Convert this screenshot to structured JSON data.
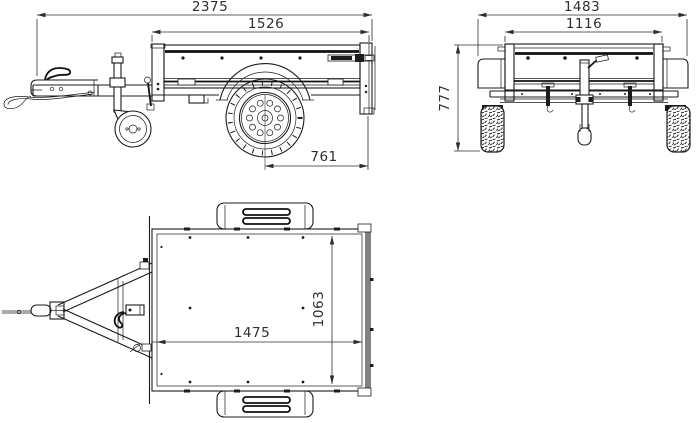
{
  "drawing": {
    "subject": "box trailer three-view technical drawing",
    "background": "#ffffff",
    "line_color": "#1c1c1c",
    "dimension_color": "#2e2e2e"
  },
  "views": {
    "side": {
      "name": "side-view",
      "dims": {
        "overall_length": "2375",
        "box_length": "1526",
        "axle_to_rear": "761"
      }
    },
    "front": {
      "name": "front-view",
      "dims": {
        "overall_width": "1483",
        "body_width": "1116",
        "overall_height": "777"
      }
    },
    "top": {
      "name": "top-view",
      "dims": {
        "inner_length": "1475",
        "inner_width": "1063"
      }
    }
  }
}
